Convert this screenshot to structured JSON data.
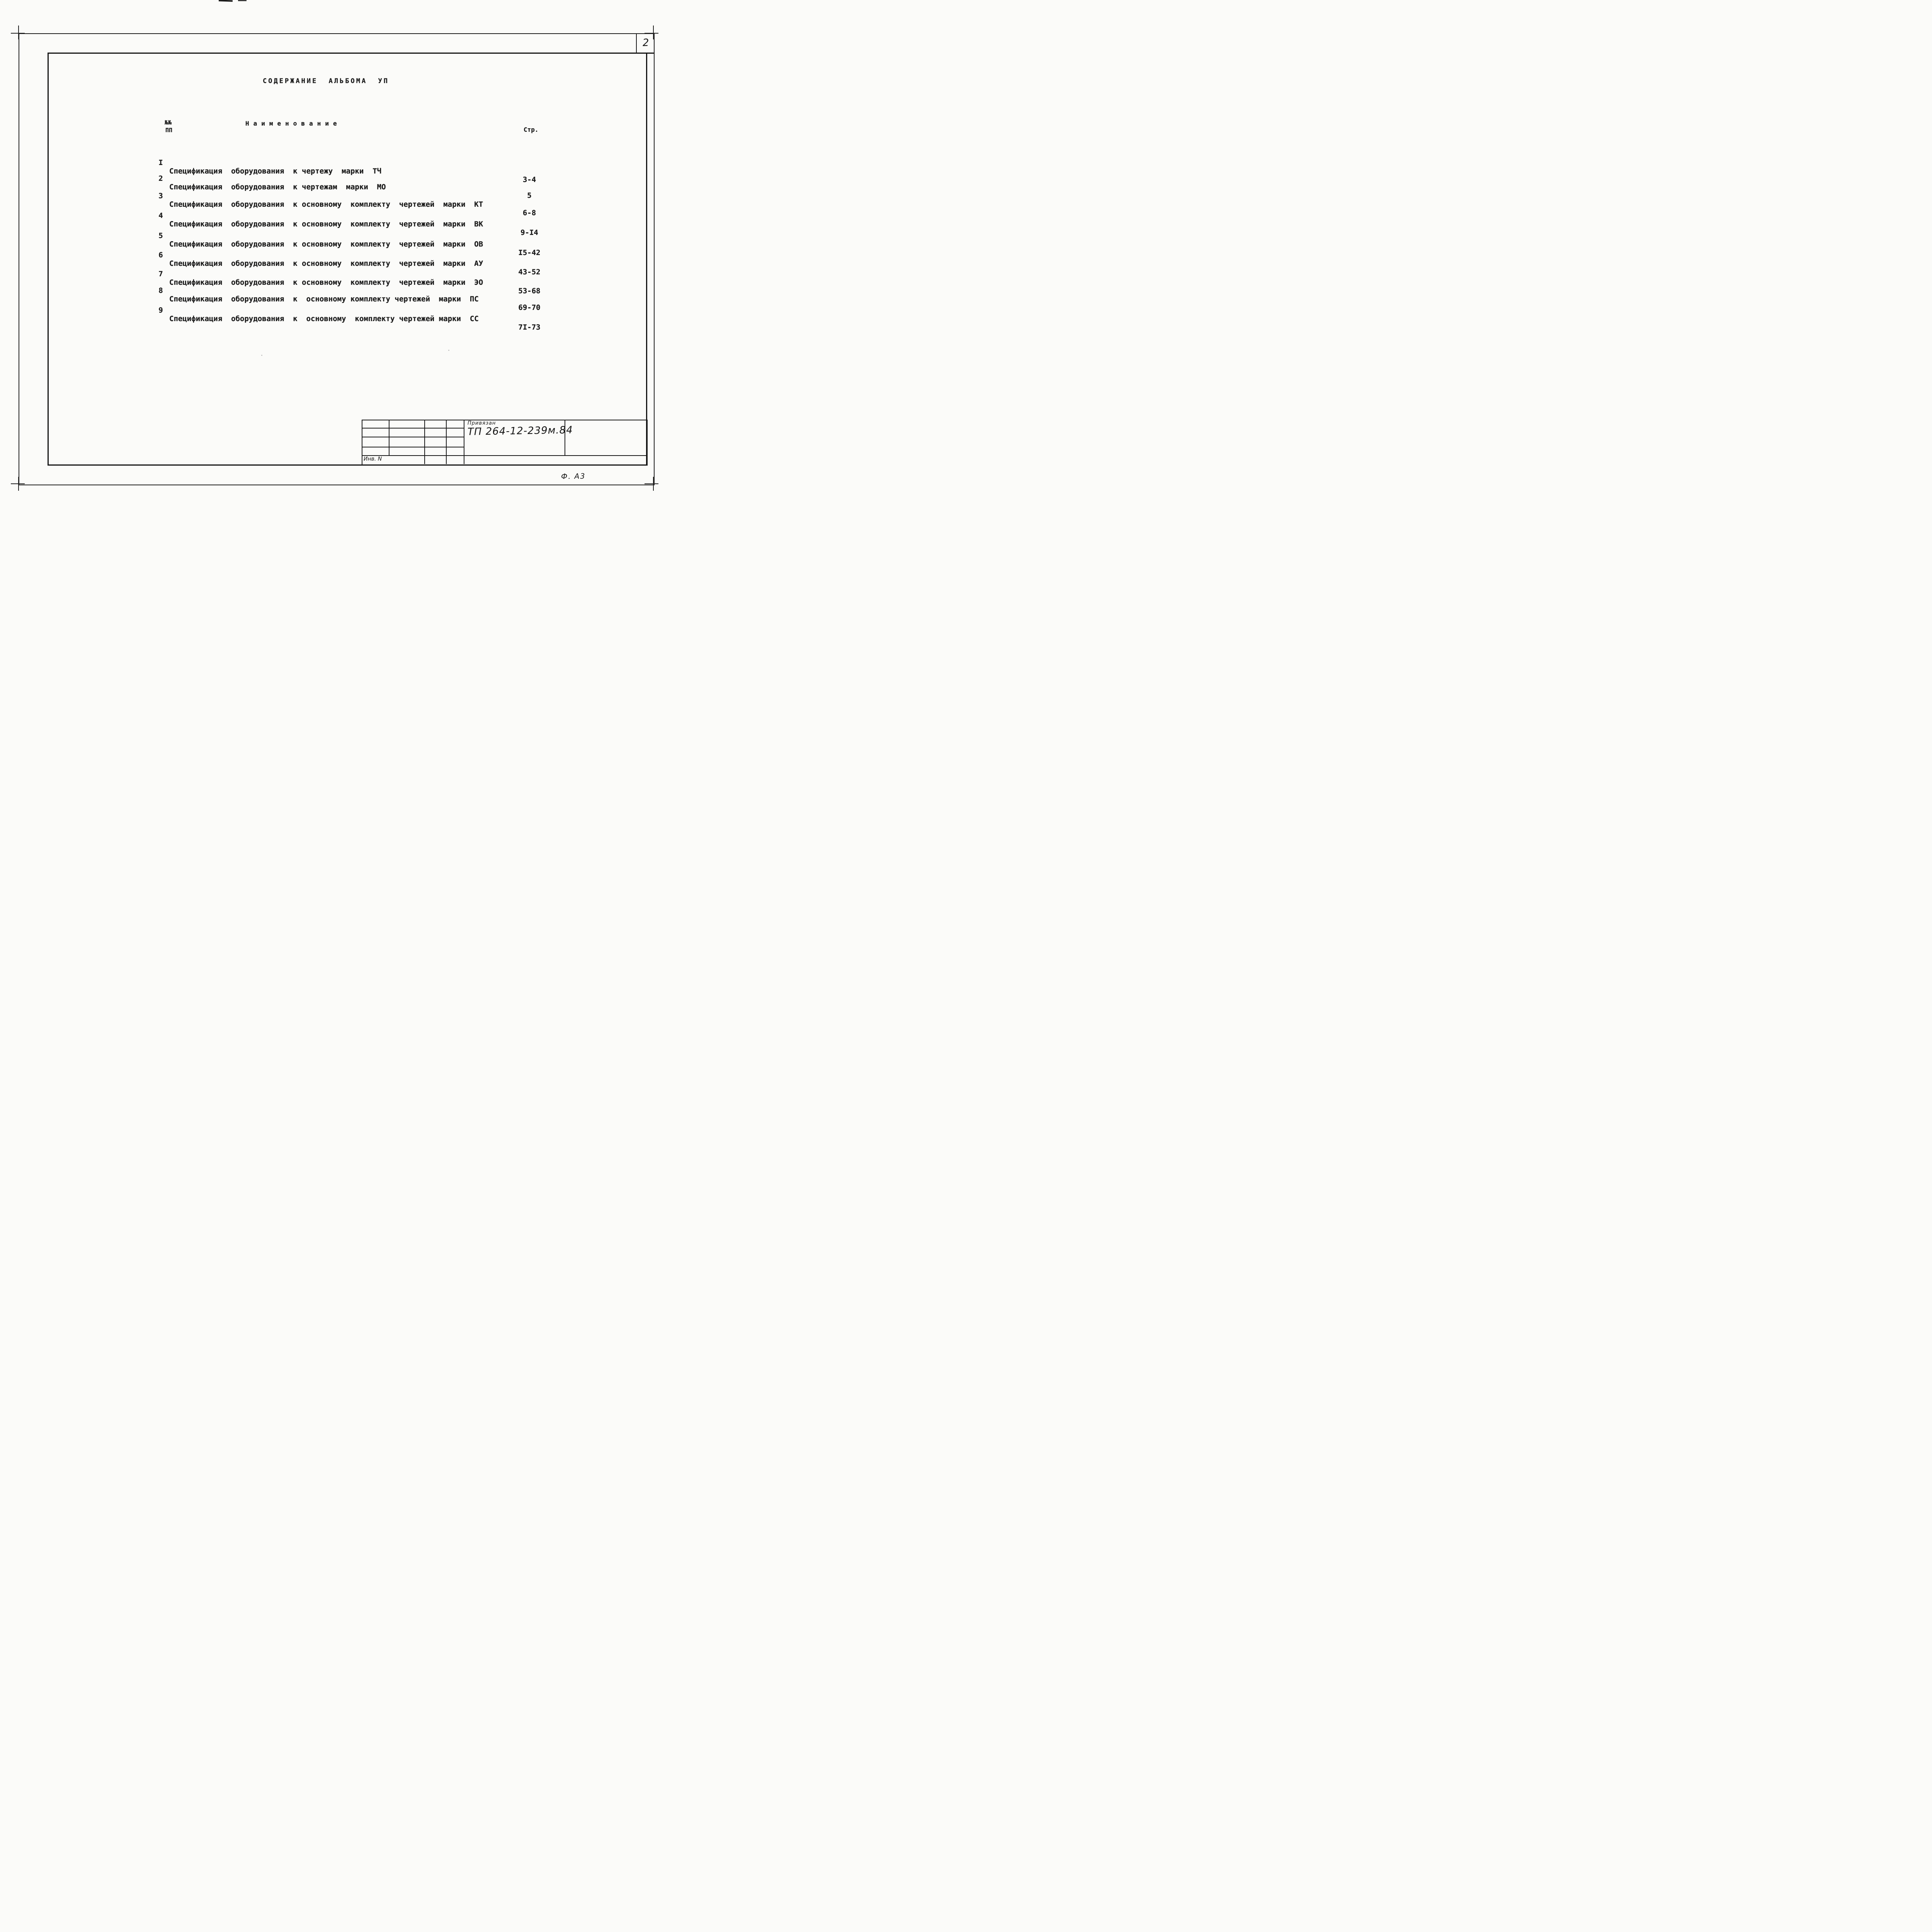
{
  "sheet": {
    "page_number": "2",
    "format_label": "Ф. А3"
  },
  "title": "СОДЕРЖАНИЕ АЛЬБОМА УП",
  "table": {
    "header": {
      "num_line1": "№№",
      "num_line2": "ПП",
      "name": "Наименование",
      "pages": "Стр."
    },
    "rows": [
      {
        "num": "I",
        "name": "Спецификация  оборудования  к чертежу  марки  ТЧ",
        "pages": "3-4"
      },
      {
        "num": "2",
        "name": "Спецификация  оборудования  к чертежам  марки  МО",
        "pages": "5"
      },
      {
        "num": "3",
        "name": "Спецификация  оборудования  к основному  комплекту  чертежей  марки  КТ",
        "pages": "6-8"
      },
      {
        "num": "4",
        "name": "Спецификация  оборудования  к основному  комплекту  чертежей  марки  ВК",
        "pages": "9-I4"
      },
      {
        "num": "5",
        "name": "Спецификация  оборудования  к основному  комплекту  чертежей  марки  ОВ",
        "pages": "I5-42"
      },
      {
        "num": "6",
        "name": "Спецификация  оборудования  к основному  комплекту  чертежей  марки  АУ",
        "pages": "43-52"
      },
      {
        "num": "7",
        "name": "Спецификация  оборудования  к основному  комплекту  чертежей  марки  ЭО",
        "pages": "53-68"
      },
      {
        "num": "8",
        "name": "Спецификация  оборудования  к  основному комплекту чертежей  марки  ПС",
        "pages": "69-70"
      },
      {
        "num": "9",
        "name": "Спецификация  оборудования  к  основному  комплекту чертежей марки  СС",
        "pages": "7I-73"
      }
    ]
  },
  "title_block": {
    "bound_label": "Привязан",
    "document_number": "ТП 264-12-239м.84",
    "inventory_label": "Инв. N"
  },
  "colors": {
    "ink": "#1b1b1b",
    "paper": "#fbfbf9"
  }
}
